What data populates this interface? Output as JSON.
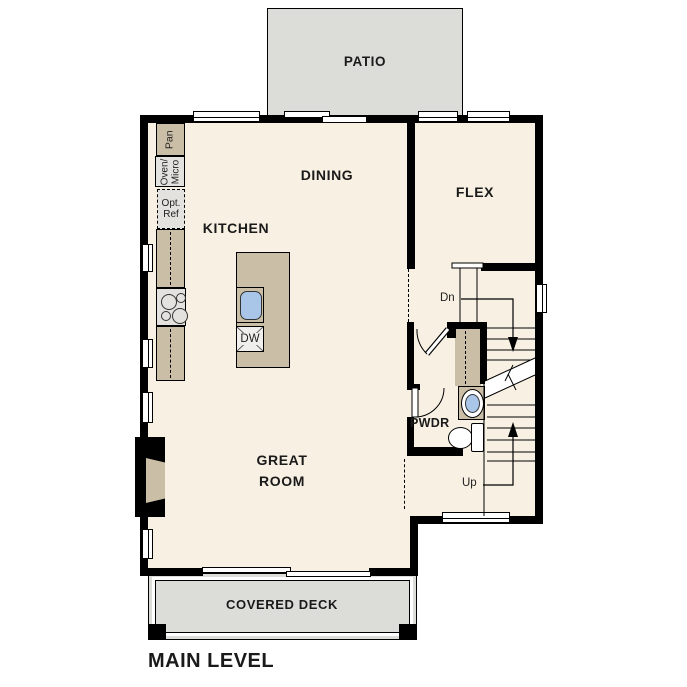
{
  "title": "MAIN LEVEL",
  "colors": {
    "floor": "#f7f0e3",
    "casework": "#cabfa6",
    "appliance": "#e3e2de",
    "outdoor": "#dcdcd9",
    "wall": "#000000",
    "sink": "#a9c6e8",
    "text": "#1a1a1a"
  },
  "rooms": {
    "patio": "PATIO",
    "dining": "DINING",
    "kitchen": "KITCHEN",
    "flex": "FLEX",
    "great_room_line1": "GREAT",
    "great_room_line2": "ROOM",
    "powder": "PWDR",
    "covered_deck": "COVERED DECK"
  },
  "fixtures": {
    "pantry": "Pan",
    "oven_micro_line1": "Oven/",
    "oven_micro_line2": "Micro",
    "opt_ref_line1": "Opt.",
    "opt_ref_line2": "Ref",
    "dishwasher": "DW"
  },
  "stairs": {
    "down_label": "Dn",
    "up_label": "Up"
  }
}
